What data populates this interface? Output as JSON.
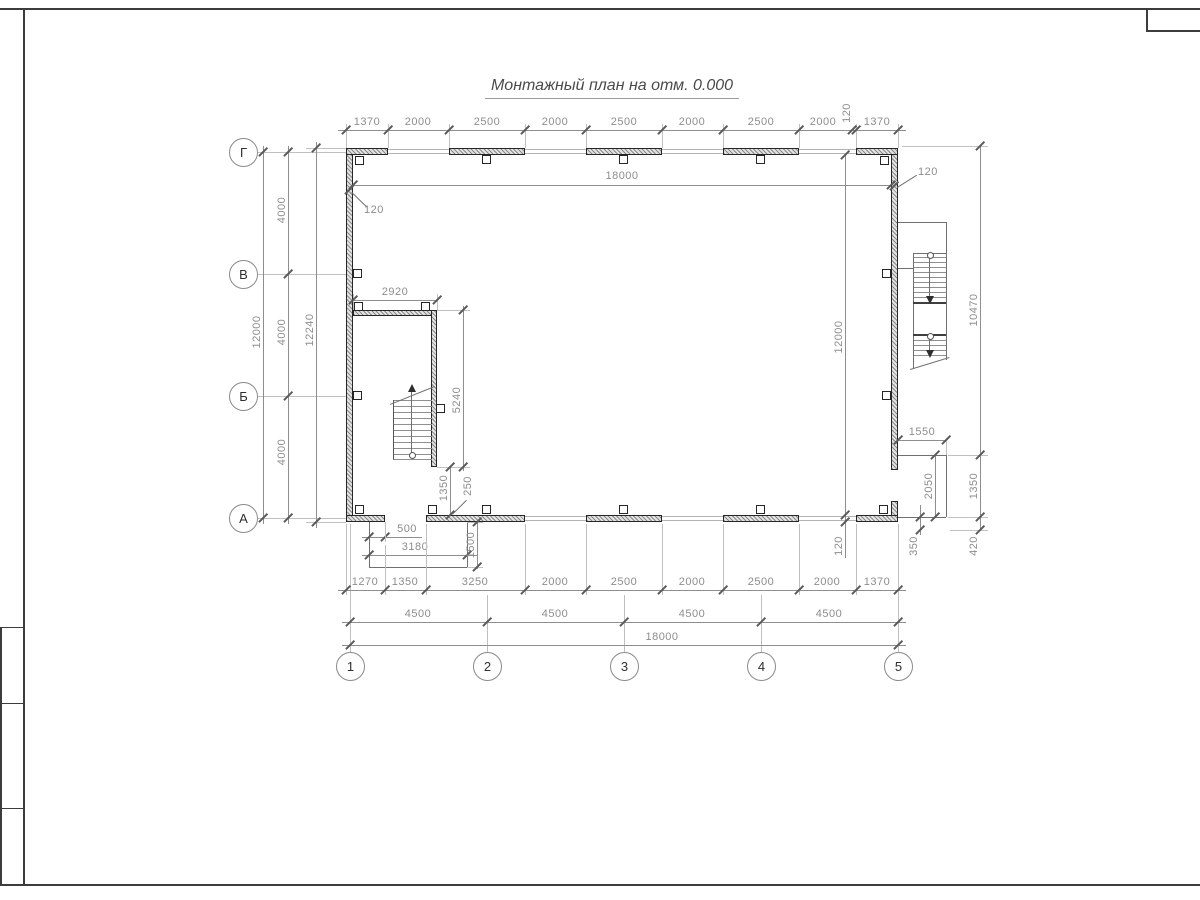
{
  "sheet": {
    "title": "Монтажный план на отм. 0.000"
  },
  "axes": {
    "rows": [
      "Г",
      "В",
      "Б",
      "А"
    ],
    "cols": [
      "1",
      "2",
      "3",
      "4",
      "5"
    ]
  },
  "dims": {
    "top_chain": [
      "1370",
      "2000",
      "2500",
      "2000",
      "2500",
      "2000",
      "2500",
      "2000",
      "120",
      "1370"
    ],
    "top_inner_width": "18000",
    "left_wall_thickness": "120",
    "right_wall_thickness": "120",
    "left_bays": [
      "4000",
      "4000",
      "4000"
    ],
    "left_total": "12000",
    "left_overall": "12240",
    "right_inner_height": "12000",
    "bottom_right_wall_thickness": "120",
    "right_upper": "10470",
    "right_mid": "1350",
    "right_lower": "420",
    "right_stair_width": "1550",
    "right_stair_depth": "2050",
    "right_stair_offset": "350",
    "room_width": "2920",
    "room_depth": "5240",
    "room_gap": "1350",
    "room_clearance": "250",
    "porch_offset": "500",
    "porch_width": "3180",
    "porch_depth": "1500",
    "bottom_chain": [
      "1270",
      "1350",
      "3250",
      "2000",
      "2500",
      "2000",
      "2500",
      "2000",
      "1370"
    ],
    "bottom_bays": [
      "4500",
      "4500",
      "4500",
      "4500"
    ],
    "bottom_total": "18000"
  }
}
